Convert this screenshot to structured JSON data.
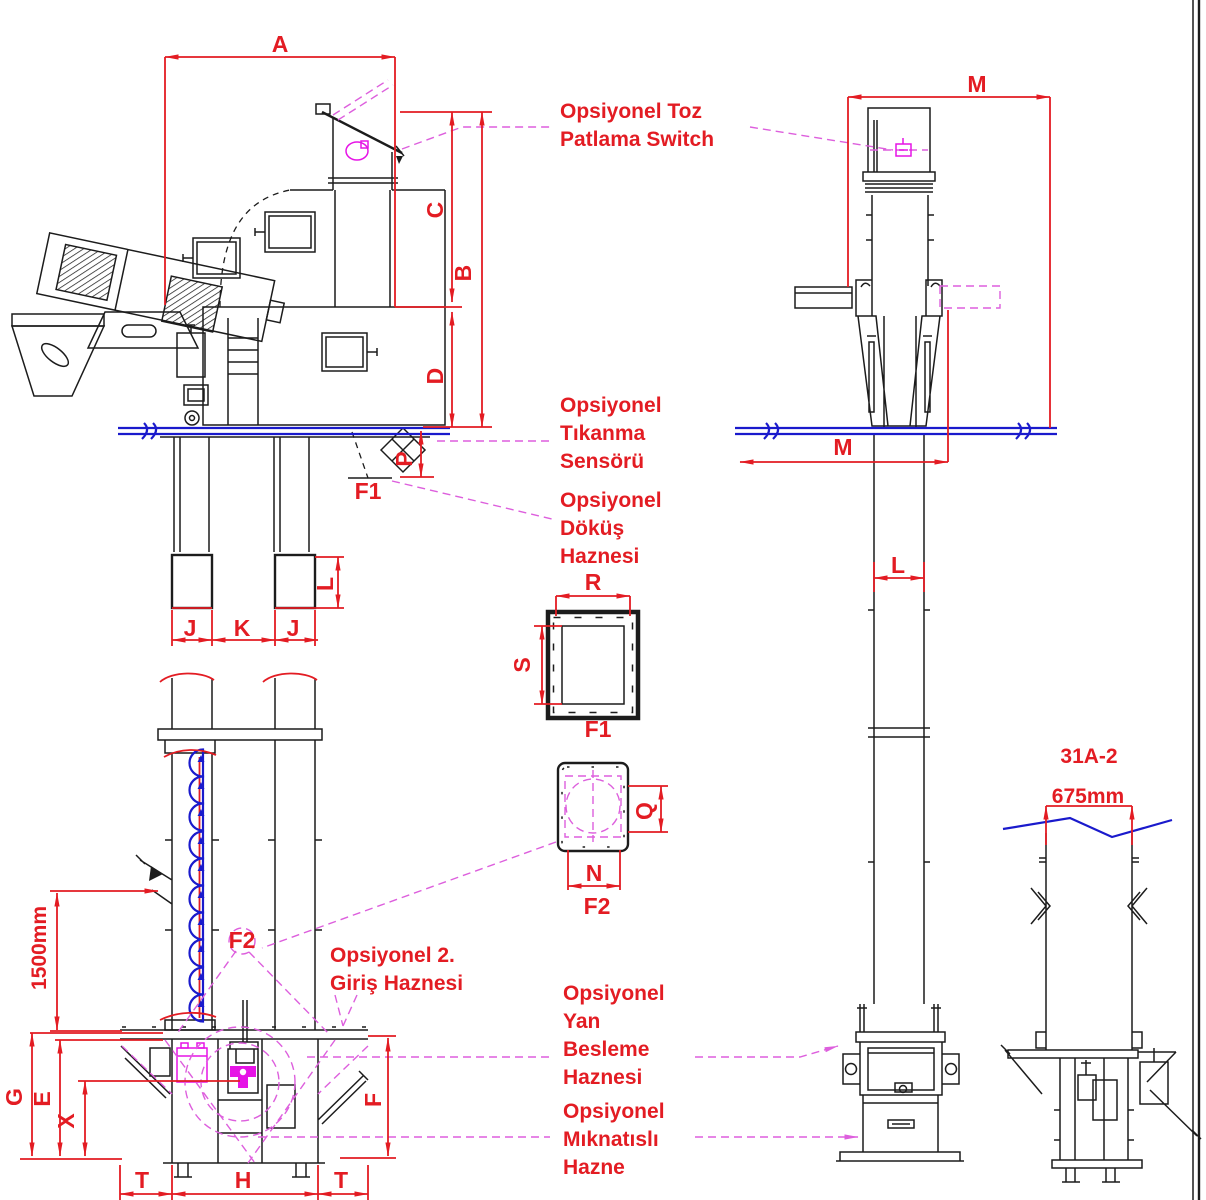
{
  "drawing": {
    "detail_code": "31A-2",
    "detail_width": "675mm",
    "feed_height": "1500mm"
  },
  "dim_labels": {
    "A": "A",
    "B": "B",
    "C": "C",
    "D": "D",
    "P": "P",
    "M_top": "M",
    "M_bottom": "M",
    "L_column": "L",
    "R": "R",
    "S": "S",
    "Q": "Q",
    "N": "N",
    "J_left": "J",
    "K": "K",
    "J_right": "J",
    "L_leg": "L",
    "G": "G",
    "E": "E",
    "X": "X",
    "F": "F",
    "T_left": "T",
    "H": "H",
    "T_right": "T"
  },
  "section_labels": {
    "f1_spout": "F1",
    "f1_section": "F1",
    "f2_section": "F2",
    "f2_callout": "F2"
  },
  "notes": {
    "toz_1": "Opsiyonel Toz",
    "toz_2": "Patlama Switch",
    "tikanma_1": "Opsiyonel",
    "tikanma_2": "Tıkanma",
    "tikanma_3": "Sensörü",
    "dokus_1": "Opsiyonel",
    "dokus_2": "Döküş",
    "dokus_3": "Haznesi",
    "giris_1": "Opsiyonel 2.",
    "giris_2": "Giriş Haznesi",
    "yan_1": "Opsiyonel",
    "yan_2": "Yan",
    "yan_3": "Besleme",
    "yan_4": "Haznesi",
    "mik_1": "Opsiyonel",
    "mik_2": "Mıknatıslı",
    "mik_3": "Hazne"
  },
  "colors": {
    "dimension_red": "#e31c23",
    "datum_blue": "#1a1acc",
    "option_magenta": "#dd5fdd",
    "device_magenta": "#e614e6",
    "line_black": "#1c1c1c",
    "background": "#ffffff"
  }
}
